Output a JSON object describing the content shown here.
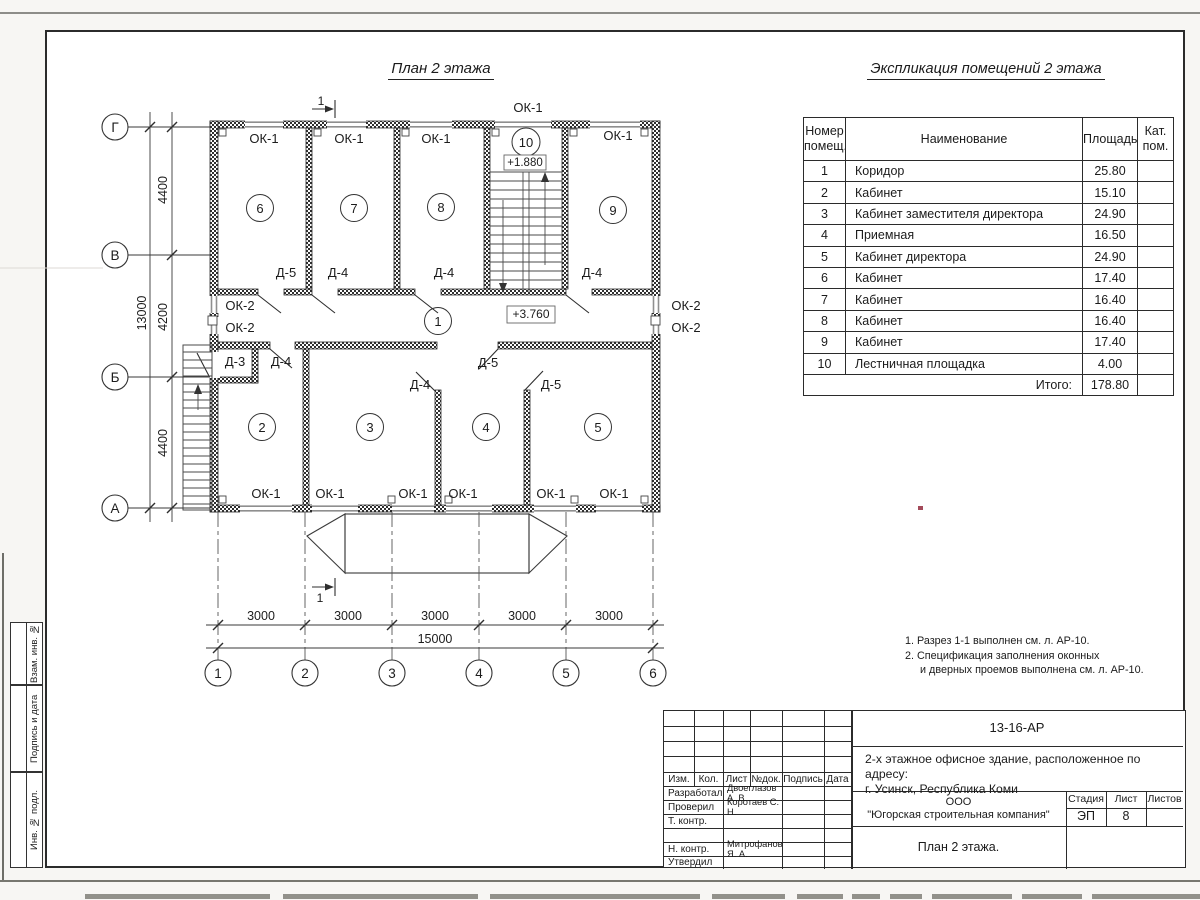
{
  "plan": {
    "title": "План 2 этажа",
    "section_label": "1",
    "ok1": "ОК-1",
    "ok2": "ОК-2",
    "d3": "Д-3",
    "d4": "Д-4",
    "d5": "Д-5",
    "level_stair": "+1.880",
    "level_floor": "+3.760",
    "rooms": [
      "1",
      "2",
      "3",
      "4",
      "5",
      "6",
      "7",
      "8",
      "9",
      "10"
    ]
  },
  "axes": {
    "rows": [
      "Г",
      "В",
      "Б",
      "А"
    ],
    "cols": [
      "1",
      "2",
      "3",
      "4",
      "5",
      "6"
    ]
  },
  "dims": {
    "left": [
      "4400",
      "4200",
      "4400"
    ],
    "left_total": "13000",
    "bottom": [
      "3000",
      "3000",
      "3000",
      "3000",
      "3000"
    ],
    "bottom_total": "15000"
  },
  "schedule": {
    "title": "Экспликация помещений 2 этажа",
    "col_number_l1": "Номер",
    "col_number_l2": "помещ.",
    "col_name": "Наименование",
    "col_area": "Площадь",
    "col_cat_l1": "Кат.",
    "col_cat_l2": "пом.",
    "rows": [
      {
        "n": "1",
        "name": "Коридор",
        "area": "25.80"
      },
      {
        "n": "2",
        "name": "Кабинет",
        "area": "15.10"
      },
      {
        "n": "3",
        "name": "Кабинет заместителя директора",
        "area": "24.90"
      },
      {
        "n": "4",
        "name": "Приемная",
        "area": "16.50"
      },
      {
        "n": "5",
        "name": "Кабинет директора",
        "area": "24.90"
      },
      {
        "n": "6",
        "name": "Кабинет",
        "area": "17.40"
      },
      {
        "n": "7",
        "name": "Кабинет",
        "area": "16.40"
      },
      {
        "n": "8",
        "name": "Кабинет",
        "area": "16.40"
      },
      {
        "n": "9",
        "name": "Кабинет",
        "area": "17.40"
      },
      {
        "n": "10",
        "name": "Лестничная площадка",
        "area": "4.00"
      }
    ],
    "total_label": "Итого:",
    "total_area": "178.80"
  },
  "notes": {
    "line1": "1. Разрез 1-1 выполнен см. л. АР-10.",
    "line2": "2. Спецификация заполнения оконных",
    "line3": "и дверных проемов выполнена см. л. АР-10."
  },
  "titleblock": {
    "doc_number": "13-16-АР",
    "object_line1": "2-х этажное офисное здание, расположенное по адресу:",
    "object_line2": "г. Усинск, Республика Коми",
    "company_line1": "ООО",
    "company_line2": "\"Югорская строительная компания\"",
    "drawing_title": "План 2 этажа.",
    "stage_label": "Стадия",
    "stage_value": "ЭП",
    "sheet_label": "Лист",
    "sheet_value": "8",
    "sheets_label": "Листов",
    "col_izm": "Изм.",
    "col_kol": "Кол.",
    "col_list": "Лист",
    "col_ndoc": "№док.",
    "col_sign": "Подпись",
    "col_date": "Дата",
    "roles": [
      {
        "role": "Разработал",
        "name": "Двоеглазов А. В."
      },
      {
        "role": "Проверил",
        "name": "Коротаев С. Н."
      },
      {
        "role": "Т. контр.",
        "name": ""
      },
      {
        "role": "",
        "name": ""
      },
      {
        "role": "Н. контр.",
        "name": "Митрофанов Я. А."
      },
      {
        "role": "Утвердил",
        "name": ""
      }
    ]
  },
  "margin": {
    "stamp1": "Взам. инв. №",
    "stamp2": "Подпись и дата",
    "stamp3": "Инв. № подл."
  }
}
